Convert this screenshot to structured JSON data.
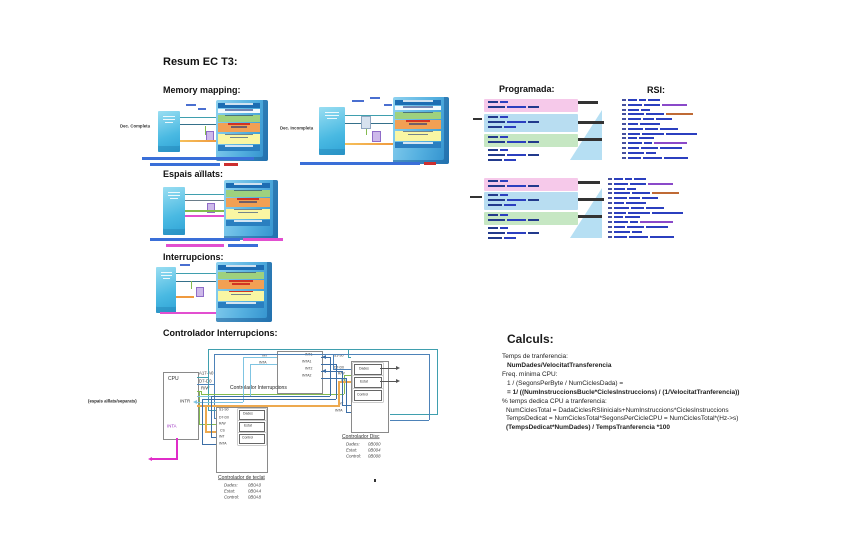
{
  "page_title": "Resum EC T3:",
  "sections": {
    "memory_mapping": {
      "heading": "Memory mapping:",
      "complete_label": "Dec. Completa",
      "incomplete_label": "Dec. Incompleta"
    },
    "programada": {
      "heading": "Programada:"
    },
    "rsi": {
      "heading": "RSI:"
    },
    "espais_aillats": {
      "heading": "Espais aïllats:"
    },
    "interrupcions": {
      "heading": "Interrupcions:"
    },
    "controlador": {
      "heading": "Controlador Interrupcions:",
      "note": "(espais aïllats/separats)",
      "cpu": {
        "title": "CPU",
        "pin_addr": "A17-A0",
        "pin_data": "D7-D0",
        "pin_rw": "R/W",
        "pin_intr": "INTR",
        "pin_inta": "INTA"
      },
      "intc": {
        "label": "Controlador Interrupcions",
        "pin_int": "INT",
        "pin_inta": "INTA",
        "right_pins": [
          "INT1",
          "INTA1",
          "INT2",
          "INTA2"
        ]
      },
      "keyboard": {
        "pins": [
          "S1-S0",
          "D7-D0",
          "R/W",
          "CS",
          "INT",
          "INTA"
        ],
        "registers": [
          "Dades",
          "Estat",
          "Control"
        ],
        "caption": "Controlador de teclat",
        "map": [
          {
            "name": "Dades:",
            "addr": "0B0A0"
          },
          {
            "name": "Estat:",
            "addr": "0B0A4"
          },
          {
            "name": "Control:",
            "addr": "0B0A8"
          }
        ]
      },
      "disc": {
        "pins": [
          "S1-S0",
          "D7-D0",
          "R/W",
          "CS",
          "INT",
          "INTA"
        ],
        "registers": [
          "Dades",
          "Estat",
          "Control"
        ],
        "caption": "Controlador Disc",
        "map": [
          {
            "name": "Dades:",
            "addr": "0B000"
          },
          {
            "name": "Estat:",
            "addr": "0B004"
          },
          {
            "name": "Control:",
            "addr": "0B008"
          }
        ]
      }
    },
    "calculs": {
      "heading": "Calculs:",
      "lines": [
        "Temps de tranferencia:",
        "NumDades/VelocitatTransferencia",
        "Freq. mínima CPU:",
        "1 / (SegonsPerByte / NumCiclesDada) =",
        "= 1/ ((NumInstruccionsBucle*CiclesInstruccions)  /  (1/VelocitatTranferencia))",
        "% temps dedica CPU a tranferencia:",
        "NumCiclesTotal = DadaCiclesRSIinicials+NumInstruccions*CiclesInstruccions",
        "TempsDedicat = NumCiclesTotal*SegonsPerCicleCPU = NumCiclesTotal*(Hz->s)",
        "(TempsDedicat*NumDades) / TempsTranferencia *100"
      ]
    }
  },
  "colors": {
    "panel_blue": "#2f8fcc",
    "row_green": "#9ed17e",
    "row_orange": "#f2a054",
    "row_yellow": "#f9f6a3",
    "band_pink": "#f6c9ea",
    "band_blue": "#b8ddf1",
    "band_green": "#c6e7c3",
    "code_blue": "#2b3fbf",
    "wire_teal": "#3f9fae",
    "wire_steel": "#4d82b8",
    "wire_lightblue": "#7fc4e2",
    "wire_orange": "#eda94f",
    "wire_green": "#84bb4f",
    "wire_magenta": "#e02cc8"
  }
}
